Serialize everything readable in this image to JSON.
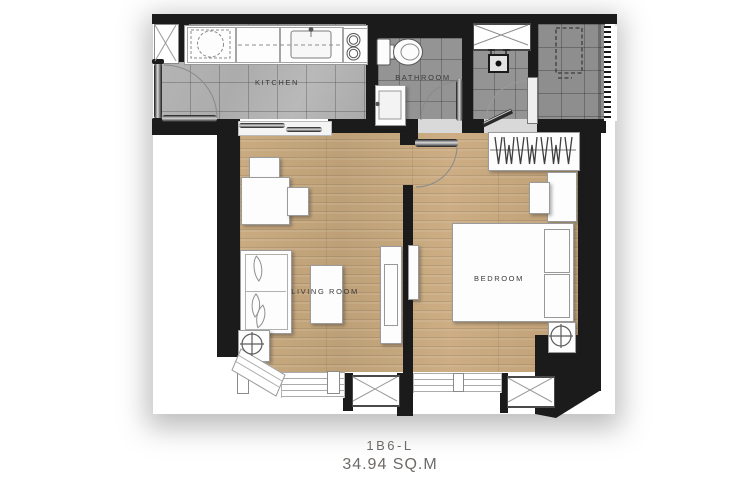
{
  "unit": {
    "name": "1B6-L",
    "area": "34.94 SQ.M"
  },
  "rooms": [
    {
      "id": "kitchen",
      "label": "KITCHEN"
    },
    {
      "id": "bathroom",
      "label": "BATHROOM"
    },
    {
      "id": "living_room",
      "label": "LIVING ROOM"
    },
    {
      "id": "bedroom",
      "label": "BEDROOM"
    }
  ],
  "colors": {
    "wall": "#1b1b1b",
    "wood_floor": "#c7a87e",
    "kitchen_tile": "#b1b1b1",
    "bath_tile": "#949494",
    "ledge_tile": "#8e8e8e",
    "label_text": "#3a3a3a",
    "title_text": "#6e6a67"
  }
}
